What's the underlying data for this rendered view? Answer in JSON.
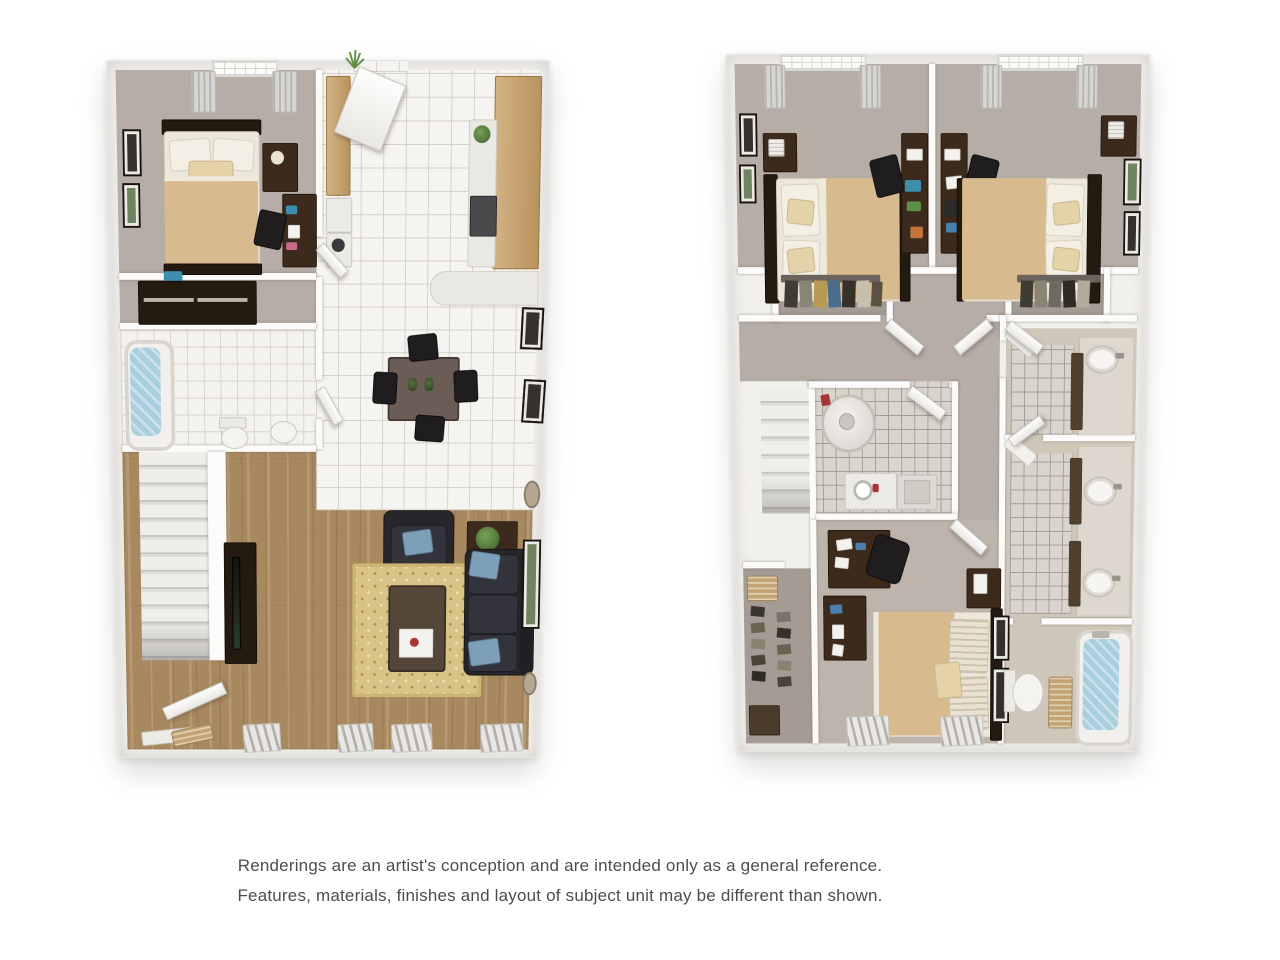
{
  "disclaimer": {
    "line1": "Renderings are an artist's conception and are intended only as a general reference.",
    "line2": "Features, materials, finishes and layout of subject unit may be different than shown."
  },
  "floor_plans": {
    "first_floor": {
      "position": "left",
      "rooms": [
        "bedroom",
        "closet",
        "bathroom",
        "entry hall with washer-dryer",
        "kitchen",
        "dining area",
        "living room",
        "staircase",
        "entry door"
      ]
    },
    "second_floor": {
      "position": "right",
      "rooms": [
        "bedroom",
        "bedroom",
        "bedroom",
        "closet",
        "closet",
        "hallway",
        "utility room with water heater and washer",
        "bathroom with vanity and shower",
        "bathroom with double vanity and shower",
        "bathroom with toilet and bathtub",
        "shoe closet",
        "staircase"
      ]
    }
  },
  "palette": {
    "page_background": "#ffffff",
    "wall": "#f2f0ed",
    "carpet": "#b7ada7",
    "wood_floor": "#a8885f",
    "tile_floor": "#f6f4f1",
    "tan_blanket": "#d7ba8d",
    "dark_wood_furniture": "#3c2b1c",
    "sofa_charcoal": "#26262b",
    "accent_pillow_blue": "#7e9fb8",
    "tub_water_blue": "#a9cede",
    "rug_gold": "#d9c386",
    "cabinet_tan": "#c9a878",
    "disclaimer_text": "#4d4d4d"
  }
}
